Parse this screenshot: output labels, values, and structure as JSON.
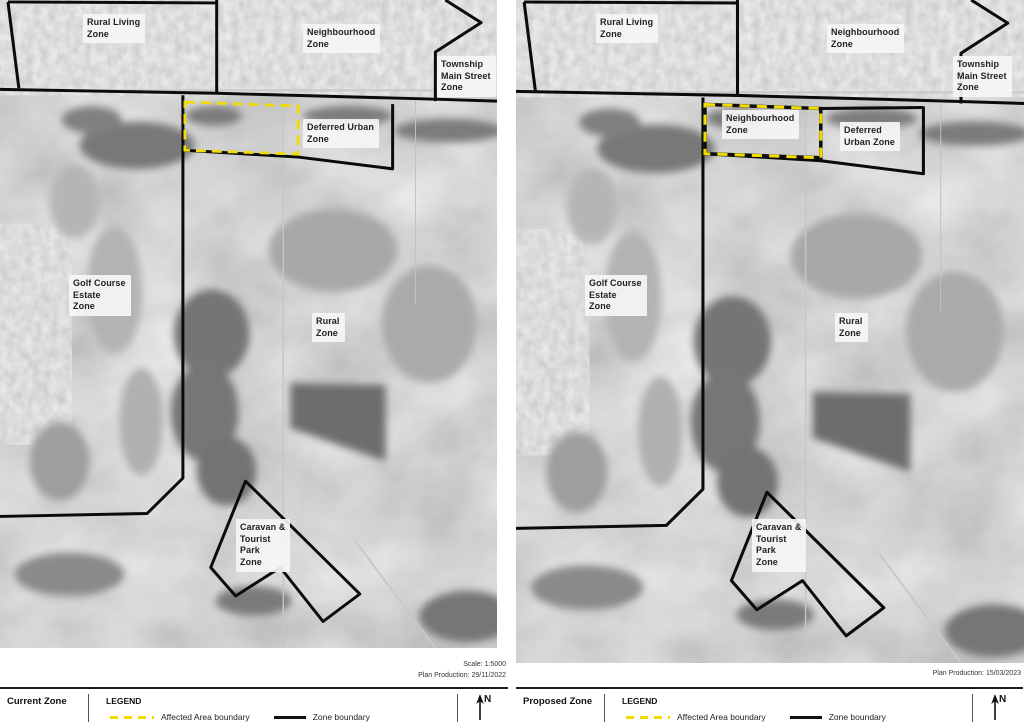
{
  "colors": {
    "affected_area": "#f2dc00",
    "zone_boundary": "#0b0b0b"
  },
  "north_label": "N",
  "legend": {
    "title": "LEGEND",
    "affected_label": "Affected Area boundary",
    "zone_label": "Zone boundary"
  },
  "panels": [
    {
      "key": "current",
      "title": "Current Zone",
      "meta_lines": [
        "Scale: 1:5000",
        "Plan Production: 29/11/2022"
      ],
      "zone_labels": [
        {
          "id": "rural-living",
          "text": "Rural Living\nZone",
          "x": 83,
          "y": 14
        },
        {
          "id": "neighbourhood",
          "text": "Neighbourhood\nZone",
          "x": 303,
          "y": 24
        },
        {
          "id": "township-main-street",
          "text": "Township\nMain Street\nZone",
          "x": 437,
          "y": 56
        },
        {
          "id": "deferred-urban",
          "text": "Deferred Urban\nZone",
          "x": 303,
          "y": 119
        },
        {
          "id": "golf-course-estate",
          "text": "Golf Course\nEstate\nZone",
          "x": 69,
          "y": 275
        },
        {
          "id": "rural",
          "text": "Rural\nZone",
          "x": 312,
          "y": 313
        },
        {
          "id": "caravan-tourist-park",
          "text": "Caravan &\nTourist\nPark\nZone",
          "x": 236,
          "y": 519
        }
      ]
    },
    {
      "key": "proposed",
      "title": "Proposed Zone",
      "meta_lines": [
        "Plan Production: 15/03/2023"
      ],
      "zone_labels": [
        {
          "id": "rural-living",
          "text": "Rural Living\nZone",
          "x": 80,
          "y": 14
        },
        {
          "id": "neighbourhood",
          "text": "Neighbourhood\nZone",
          "x": 311,
          "y": 24
        },
        {
          "id": "township-main-street",
          "text": "Township\nMain Street\nZone",
          "x": 437,
          "y": 56
        },
        {
          "id": "neighbourhood-affected",
          "text": "Neighbourhood\nZone",
          "x": 206,
          "y": 110
        },
        {
          "id": "deferred-urban",
          "text": "Deferred\nUrban Zone",
          "x": 324,
          "y": 122
        },
        {
          "id": "golf-course-estate",
          "text": "Golf Course\nEstate\nZone",
          "x": 69,
          "y": 275
        },
        {
          "id": "rural",
          "text": "Rural\nZone",
          "x": 319,
          "y": 313
        },
        {
          "id": "caravan-tourist-park",
          "text": "Caravan &\nTourist\nPark\nZone",
          "x": 236,
          "y": 519
        }
      ]
    }
  ]
}
